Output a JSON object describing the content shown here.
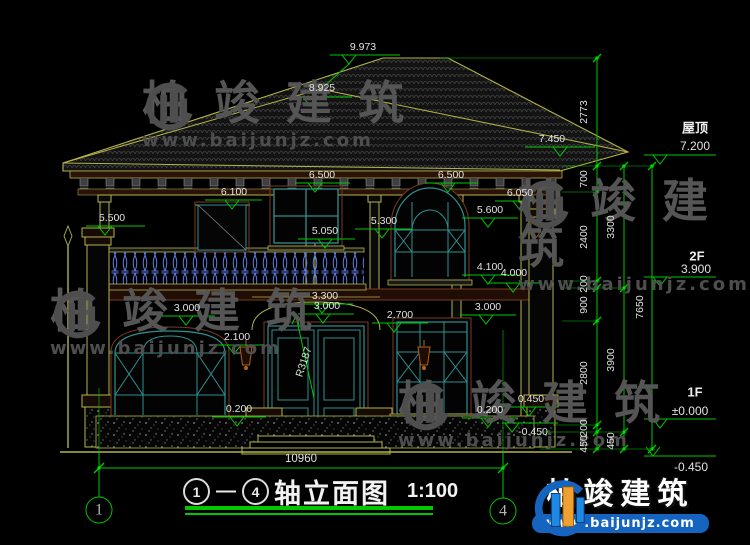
{
  "title": {
    "axis_left": "1",
    "axis_right": "4",
    "dash": "—",
    "name": "轴立面图",
    "scale": "1:100"
  },
  "axes": {
    "left": "1",
    "right": "4"
  },
  "overall_width": "10960",
  "radius": "R3187",
  "levels": {
    "roof": {
      "label": "屋顶",
      "value": "7.200"
    },
    "f2": {
      "label": "2F",
      "value": "3.900"
    },
    "f1": {
      "label": "1F",
      "value": "±0.000"
    },
    "ground": {
      "value": "-0.450"
    }
  },
  "marks": {
    "ridge": "9.973",
    "ridge_front": "8.925",
    "eave_right": "7.450",
    "win2f_left": "6.500",
    "win2f_right": "6.500",
    "porch": "6.100",
    "right_cornice": "6.050",
    "right_cap": "5.600",
    "left_cap": "5.500",
    "mid_cap": "5.300",
    "rail": "5.050",
    "sill2f": "4.100",
    "sill2f_b": "4.000",
    "arch_top": "3.300",
    "arch": "3.000",
    "win1f_left": "3.000",
    "win1f_right": "3.000",
    "transom": "2.700",
    "spring": "2.100",
    "sill1f_left": "0.200",
    "sill1f_right": "0.200",
    "plinth": "0.450",
    "ground_neg": "-0.450"
  },
  "chains": {
    "inner": [
      "2773",
      "700",
      "2400",
      "200",
      "900",
      "2800",
      "200",
      "450"
    ],
    "middle": [
      "3300",
      "3900",
      "450"
    ],
    "outer": [
      "7650"
    ]
  },
  "watermark": {
    "brand": "柏竣建筑",
    "site": "www.baijunjz.com"
  },
  "logo": {
    "brand": "柏竣建筑",
    "site": "www.baijunjz.com"
  },
  "colors": {
    "dim_green": "#00c800",
    "cad_yellow": "#b5b449",
    "frame_teal": "#2f9090",
    "rail_blue": "#5b7ce0",
    "logo_blue": "#1565c0",
    "logo_orange": "#f0a030"
  }
}
